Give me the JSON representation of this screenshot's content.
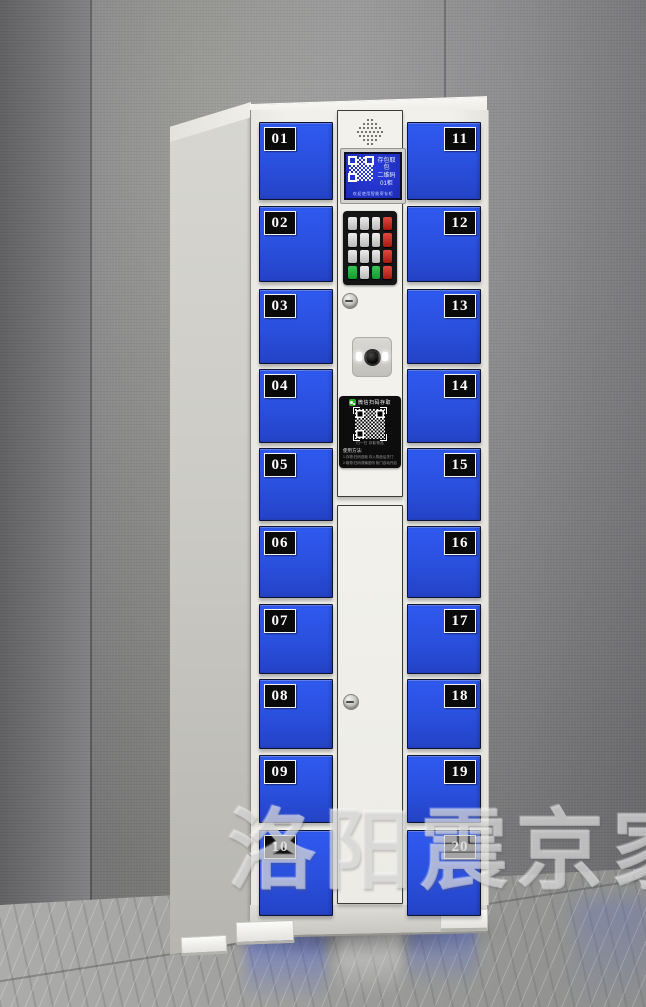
{
  "watermark": {
    "text": "洛阳震京家具"
  },
  "locker": {
    "left_doors": [
      "01",
      "02",
      "03",
      "04",
      "05",
      "06",
      "07",
      "08",
      "09",
      "10"
    ],
    "right_doors": [
      "11",
      "12",
      "13",
      "14",
      "15",
      "16",
      "17",
      "18",
      "19",
      "20"
    ],
    "screen": {
      "line1": "存包取包",
      "line2": "二维码",
      "line3": "01柜",
      "footer": "欢迎使用智能寄存柜"
    },
    "wechat_panel": {
      "header": "微信扫码存取",
      "qr_caption": "扫一扫 存取物品",
      "usage_title": "使用方法:",
      "usage_line1": "1.存物:扫码选柜 存入物品后关门",
      "usage_line2": "2.取物:扫码或输密码 柜门自动开启"
    },
    "colors": {
      "door_blue": "#2b52e2",
      "label_bg": "#0a0a0a",
      "label_text": "#ffffff",
      "cabinet_body": "#f1f0eb",
      "lcd_screen_blue": "#2435cf",
      "keypad_key_red": "#c3271e",
      "keypad_key_green": "#1ea83a",
      "wechat_green": "#29b324",
      "panel_black": "#0d0d0d"
    }
  }
}
